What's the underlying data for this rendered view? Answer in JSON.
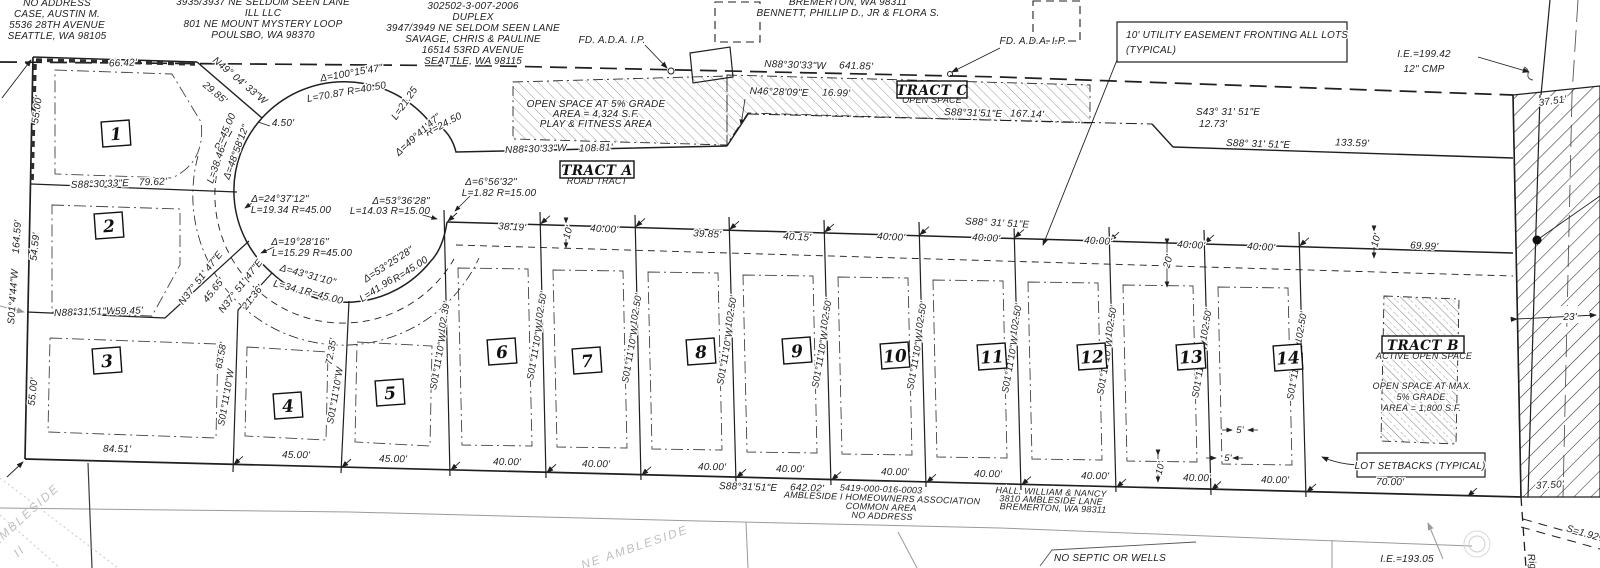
{
  "colors": {
    "ink": "#1f1f1f",
    "gray": "#8c8c8c",
    "ghost": "#c0c0c0",
    "hatch_light": "#6a6a6a",
    "hatch_dark": "#2e2e2e"
  },
  "lots": [
    {
      "n": "1",
      "x": 116,
      "y": 134
    },
    {
      "n": "2",
      "x": 109,
      "y": 226
    },
    {
      "n": "3",
      "x": 107,
      "y": 361
    },
    {
      "n": "4",
      "x": 288,
      "y": 406
    },
    {
      "n": "5",
      "x": 390,
      "y": 393
    },
    {
      "n": "6",
      "x": 502,
      "y": 352
    },
    {
      "n": "7",
      "x": 587,
      "y": 361
    },
    {
      "n": "8",
      "x": 701,
      "y": 352
    },
    {
      "n": "9",
      "x": 797,
      "y": 351
    },
    {
      "n": "10",
      "x": 895,
      "y": 356
    },
    {
      "n": "11",
      "x": 992,
      "y": 357
    },
    {
      "n": "12",
      "x": 1092,
      "y": 357
    },
    {
      "n": "13",
      "x": 1191,
      "y": 357
    },
    {
      "n": "14",
      "x": 1288,
      "y": 358
    }
  ],
  "tracts": [
    {
      "name": "TRACT A",
      "x": 597,
      "y": 170,
      "w": 74
    },
    {
      "name": "TRACT B",
      "x": 1423,
      "y": 345,
      "w": 82
    },
    {
      "name": "TRACT C",
      "x": 932,
      "y": 90,
      "w": 70
    }
  ],
  "labels": [
    {
      "t": "NO ADDRESS",
      "x": 57,
      "y": 6
    },
    {
      "t": "CASE, AUSTIN M.",
      "x": 57,
      "y": 17
    },
    {
      "t": "5536 28TH AVENUE",
      "x": 57,
      "y": 28
    },
    {
      "t": "SEATTLE, WA  98105",
      "x": 57,
      "y": 39
    },
    {
      "t": "3935/3937 NE SELDOM SEEN LANE",
      "x": 263,
      "y": 5
    },
    {
      "t": "ILL LLC",
      "x": 263,
      "y": 16
    },
    {
      "t": "801 NE MOUNT MYSTERY LOOP",
      "x": 263,
      "y": 27
    },
    {
      "t": "POULSBO, WA  98370",
      "x": 263,
      "y": 38
    },
    {
      "t": "302502-3-007-2006",
      "x": 473,
      "y": 9
    },
    {
      "t": "DUPLEX",
      "x": 473,
      "y": 20
    },
    {
      "t": "3947/3949 NE SELDOM SEEN LANE",
      "x": 473,
      "y": 31
    },
    {
      "t": "SAVAGE, CHRIS & PAULINE",
      "x": 473,
      "y": 42
    },
    {
      "t": "16514 53RD AVENUE",
      "x": 473,
      "y": 53
    },
    {
      "t": "SEATTLE, WA  98115",
      "x": 473,
      "y": 64
    },
    {
      "t": "BREMERTON, WA  98311",
      "x": 848,
      "y": 5
    },
    {
      "t": "BENNETT, PHILLIP D., JR & FLORA S.",
      "x": 848,
      "y": 16
    },
    {
      "t": "FD. A.D.A. I.P.",
      "x": 612,
      "y": 43
    },
    {
      "t": "FD. A.D.A. I.P.",
      "x": 1033,
      "y": 44
    },
    {
      "t": "10' UTILITY EASEMENT FRONTING ALL LOTS",
      "x": 1126,
      "y": 38,
      "a": "start"
    },
    {
      "t": "(TYPICAL)",
      "x": 1126,
      "y": 53,
      "a": "start"
    },
    {
      "t": "I.E.=199.42",
      "x": 1424,
      "y": 57
    },
    {
      "t": "12\" CMP",
      "x": 1424,
      "y": 72
    },
    {
      "t": "37.51'",
      "x": 1553,
      "y": 104,
      "r": -8
    },
    {
      "t": "66.42'",
      "x": 123,
      "y": 66,
      "r": -2
    },
    {
      "t": "N49° 04' 33\"W",
      "x": 238,
      "y": 83,
      "r": 40
    },
    {
      "t": "29.85'",
      "x": 213,
      "y": 95,
      "r": 40
    },
    {
      "t": "Δ=100°15'47\"",
      "x": 352,
      "y": 76,
      "r": -10
    },
    {
      "t": "L=70.87   R=40.50",
      "x": 347,
      "y": 95,
      "r": -10
    },
    {
      "t": "4.50'",
      "x": 283,
      "y": 126
    },
    {
      "t": "R=45.00",
      "x": 228,
      "y": 133,
      "r": -67
    },
    {
      "t": "Δ=48°58'12\"",
      "x": 239,
      "y": 153,
      "r": -70
    },
    {
      "t": "L=38.46",
      "x": 219,
      "y": 166,
      "r": -71
    },
    {
      "t": "L=21.25",
      "x": 407,
      "y": 105,
      "r": -55
    },
    {
      "t": "R=24.50",
      "x": 445,
      "y": 127,
      "r": -28
    },
    {
      "t": "Δ=49°41'47\"",
      "x": 420,
      "y": 137,
      "r": -42
    },
    {
      "t": "Δ=24°37'12\"",
      "x": 280,
      "y": 202
    },
    {
      "t": "L=19.34   R=45.00",
      "x": 291,
      "y": 213
    },
    {
      "t": "Δ=19°28'16\"",
      "x": 300,
      "y": 245
    },
    {
      "t": "L=15.29   R=45.00",
      "x": 312,
      "y": 256
    },
    {
      "t": "Δ=43°31'10\"",
      "x": 307,
      "y": 278,
      "r": 15
    },
    {
      "t": "L=34.18",
      "x": 291,
      "y": 291,
      "r": 15
    },
    {
      "t": "R=45.00",
      "x": 323,
      "y": 299,
      "r": 15
    },
    {
      "t": "Δ=53°25'28\"",
      "x": 390,
      "y": 267,
      "r": -33
    },
    {
      "t": "L=41.96",
      "x": 378,
      "y": 292,
      "r": -33
    },
    {
      "t": "R=45.00",
      "x": 412,
      "y": 272,
      "r": -33
    },
    {
      "t": "Δ=53°36'28\"",
      "x": 401,
      "y": 204
    },
    {
      "t": "L=14.03   R=15.00",
      "x": 390,
      "y": 214
    },
    {
      "t": "Δ=6°56'32\"",
      "x": 491,
      "y": 185
    },
    {
      "t": "L=1.82   R=15.00",
      "x": 499,
      "y": 196
    },
    {
      "t": "N37° 51' 47\"E",
      "x": 203,
      "y": 280,
      "r": -52
    },
    {
      "t": "45.65'",
      "x": 216,
      "y": 292,
      "r": -52
    },
    {
      "t": "N37° 51' 47\"E",
      "x": 243,
      "y": 288,
      "r": -52
    },
    {
      "t": "21.36'",
      "x": 255,
      "y": 299,
      "r": -52
    },
    {
      "t": "S88°30'33\"E",
      "x": 100,
      "y": 187,
      "r": -2
    },
    {
      "t": "79.62'",
      "x": 153,
      "y": 185,
      "r": -2
    },
    {
      "t": "55.00'",
      "x": 40,
      "y": 110,
      "r": -82
    },
    {
      "t": "164.59'",
      "x": 20,
      "y": 237,
      "r": -86
    },
    {
      "t": "S01°4'44\"W",
      "x": 16,
      "y": 297,
      "r": -86
    },
    {
      "t": "54.59'",
      "x": 38,
      "y": 247,
      "r": -84
    },
    {
      "t": "55.00'",
      "x": 36,
      "y": 392,
      "r": -84
    },
    {
      "t": "N88°31'51\"W",
      "x": 85,
      "y": 315,
      "r": -2
    },
    {
      "t": "59.45'",
      "x": 129,
      "y": 314,
      "r": -2
    },
    {
      "t": "63.58'",
      "x": 224,
      "y": 356,
      "r": -80,
      "s": 9.5
    },
    {
      "t": "S01°11'10\"W",
      "x": 229,
      "y": 398,
      "r": -80,
      "s": 9.5
    },
    {
      "t": "72.35'",
      "x": 334,
      "y": 352,
      "r": -80,
      "s": 9.5
    },
    {
      "t": "S01°11'10\"W",
      "x": 338,
      "y": 396,
      "r": -80,
      "s": 9.5
    },
    {
      "t": "102.39'",
      "x": 447,
      "y": 318,
      "r": -80,
      "s": 9.5
    },
    {
      "t": "S01°11'10\"W",
      "x": 441,
      "y": 362,
      "r": -80,
      "s": 9.5
    },
    {
      "t": "102.50'",
      "x": 544,
      "y": 308,
      "r": -80,
      "s": 9.5
    },
    {
      "t": "S01°11'10\"W",
      "x": 538,
      "y": 352,
      "r": -80,
      "s": 9.5
    },
    {
      "t": "102.50'",
      "x": 639,
      "y": 310,
      "r": -80,
      "s": 9.5
    },
    {
      "t": "S01°11'10\"W",
      "x": 633,
      "y": 355,
      "r": -80,
      "s": 9.5
    },
    {
      "t": "102.50'",
      "x": 734,
      "y": 312,
      "r": -80,
      "s": 9.5
    },
    {
      "t": "S01°11'10\"W",
      "x": 728,
      "y": 357,
      "r": -80,
      "s": 9.5
    },
    {
      "t": "102.50'",
      "x": 829,
      "y": 315,
      "r": -80,
      "s": 9.5
    },
    {
      "t": "S01°11'10\"W",
      "x": 823,
      "y": 360,
      "r": -80,
      "s": 9.5
    },
    {
      "t": "102.50'",
      "x": 924,
      "y": 318,
      "r": -80,
      "s": 9.5
    },
    {
      "t": "S01°11'10\"W",
      "x": 918,
      "y": 362,
      "r": -80,
      "s": 9.5
    },
    {
      "t": "102.50'",
      "x": 1019,
      "y": 320,
      "r": -80,
      "s": 9.5
    },
    {
      "t": "S01°11'10\"W",
      "x": 1013,
      "y": 365,
      "r": -80,
      "s": 9.5
    },
    {
      "t": "102.50'",
      "x": 1114,
      "y": 322,
      "r": -80,
      "s": 9.5
    },
    {
      "t": "S01°11'10\"W",
      "x": 1108,
      "y": 367,
      "r": -80,
      "s": 9.5
    },
    {
      "t": "102.50'",
      "x": 1209,
      "y": 325,
      "r": -80,
      "s": 9.5
    },
    {
      "t": "S01°11'10\"W",
      "x": 1203,
      "y": 370,
      "r": -80,
      "s": 9.5
    },
    {
      "t": "102.50'",
      "x": 1304,
      "y": 328,
      "r": -80,
      "s": 9.5
    },
    {
      "t": "S01°11'10\"W",
      "x": 1298,
      "y": 372,
      "r": -80,
      "s": 9.5
    },
    {
      "t": "38.19'",
      "x": 512,
      "y": 230,
      "r": 3
    },
    {
      "t": "10'",
      "x": 571,
      "y": 233,
      "r": -75
    },
    {
      "t": "40.00'",
      "x": 604,
      "y": 232,
      "r": 3
    },
    {
      "t": "39.85'",
      "x": 707,
      "y": 237,
      "r": 3
    },
    {
      "t": "40.15'",
      "x": 797,
      "y": 240,
      "r": 3
    },
    {
      "t": "40.00'",
      "x": 891,
      "y": 240,
      "r": 3
    },
    {
      "t": "40.00'",
      "x": 986,
      "y": 241,
      "r": 3
    },
    {
      "t": "40.00'",
      "x": 1098,
      "y": 244,
      "r": 3
    },
    {
      "t": "40.00'",
      "x": 1191,
      "y": 248,
      "r": 3
    },
    {
      "t": "40.00'",
      "x": 1261,
      "y": 250,
      "r": 3
    },
    {
      "t": "S88° 31' 51\"E",
      "x": 997,
      "y": 226,
      "r": 3
    },
    {
      "t": "20'",
      "x": 1171,
      "y": 262,
      "r": -75
    },
    {
      "t": "10'",
      "x": 1379,
      "y": 241,
      "r": -75
    },
    {
      "t": "69.99'",
      "x": 1424,
      "y": 249,
      "r": 3
    },
    {
      "t": "N88°30'33\"W",
      "x": 536,
      "y": 152,
      "r": -2
    },
    {
      "t": "108.81'",
      "x": 596,
      "y": 151,
      "r": -2
    },
    {
      "t": "ROAD TRACT",
      "x": 597,
      "y": 184,
      "s": 9
    },
    {
      "t": "N88°30'33\"W",
      "x": 795,
      "y": 68,
      "r": 2
    },
    {
      "t": "641.85'",
      "x": 856,
      "y": 69,
      "r": 2
    },
    {
      "t": "N46°28'09\"E",
      "x": 779,
      "y": 95,
      "r": 2
    },
    {
      "t": "16.99'",
      "x": 836,
      "y": 96,
      "r": 2
    },
    {
      "t": "OPEN SPACE",
      "x": 932,
      "y": 103,
      "s": 9
    },
    {
      "t": "S88°31'51\"E",
      "x": 973,
      "y": 116,
      "r": 2
    },
    {
      "t": "167.14'",
      "x": 1027,
      "y": 117,
      "r": 2
    },
    {
      "t": "S43° 31' 51\"E",
      "x": 1228,
      "y": 115
    },
    {
      "t": "12.73'",
      "x": 1213,
      "y": 127
    },
    {
      "t": "S88° 31' 51\"E",
      "x": 1258,
      "y": 147,
      "r": 2
    },
    {
      "t": "133.59'",
      "x": 1352,
      "y": 146,
      "r": 2
    },
    {
      "t": "OPEN SPACE AT 5% GRADE",
      "x": 596,
      "y": 107
    },
    {
      "t": "AREA = 4,324 S.F.",
      "x": 596,
      "y": 117
    },
    {
      "t": "PLAY & FITNESS AREA",
      "x": 596,
      "y": 127
    },
    {
      "t": "ACTIVE OPEN SPACE",
      "x": 1424,
      "y": 359,
      "s": 9
    },
    {
      "t": "OPEN SPACE AT MAX.",
      "x": 1422,
      "y": 389,
      "s": 9
    },
    {
      "t": "5% GRADE",
      "x": 1421,
      "y": 400,
      "s": 9
    },
    {
      "t": "AREA = 1,800 S.F.",
      "x": 1422,
      "y": 411,
      "s": 9
    },
    {
      "t": "23'",
      "x": 1570,
      "y": 320
    },
    {
      "t": "37.50'",
      "x": 1550,
      "y": 488,
      "r": -3
    },
    {
      "t": "S=1.92%",
      "x": 1586,
      "y": 537,
      "r": 16
    },
    {
      "t": "Rig",
      "x": 1529,
      "y": 562,
      "r": 80
    },
    {
      "t": "5'",
      "x": 1240,
      "y": 433,
      "s": 9.5
    },
    {
      "t": "5'",
      "x": 1228,
      "y": 461,
      "s": 9.5
    },
    {
      "t": "10'",
      "x": 1163,
      "y": 469,
      "r": -75,
      "s": 9.5
    },
    {
      "t": "LOT SETBACKS (TYPICAL)",
      "x": 1420,
      "y": 469
    },
    {
      "t": "84.51'",
      "x": 117,
      "y": 452,
      "r": 1
    },
    {
      "t": "45.00'",
      "x": 296,
      "y": 458,
      "r": 1
    },
    {
      "t": "45.00'",
      "x": 393,
      "y": 462,
      "r": 1
    },
    {
      "t": "40.00'",
      "x": 507,
      "y": 465,
      "r": 1
    },
    {
      "t": "40.00'",
      "x": 596,
      "y": 467,
      "r": 1
    },
    {
      "t": "40.00'",
      "x": 712,
      "y": 470,
      "r": 1
    },
    {
      "t": "40.00'",
      "x": 790,
      "y": 472,
      "r": 1
    },
    {
      "t": "40.00'",
      "x": 895,
      "y": 475,
      "r": 1
    },
    {
      "t": "40.00'",
      "x": 988,
      "y": 477,
      "r": 1
    },
    {
      "t": "40.00'",
      "x": 1095,
      "y": 479,
      "r": 1
    },
    {
      "t": "40.00'",
      "x": 1197,
      "y": 481,
      "r": 1
    },
    {
      "t": "40.00'",
      "x": 1275,
      "y": 483,
      "r": 1
    },
    {
      "t": "70.00'",
      "x": 1390,
      "y": 485,
      "r": 1
    },
    {
      "t": "S88°31'51\"E",
      "x": 748,
      "y": 490,
      "r": 2
    },
    {
      "t": "642.02'",
      "x": 807,
      "y": 491,
      "r": 2
    },
    {
      "t": "5419-000-016-0003",
      "x": 881,
      "y": 492,
      "r": 2,
      "s": 9
    },
    {
      "t": "AMBLESIDE I HOMEOWNERS ASSOCIATION",
      "x": 882,
      "y": 501,
      "r": 2,
      "s": 9
    },
    {
      "t": "COMMON AREA",
      "x": 881,
      "y": 510,
      "r": 2,
      "s": 9
    },
    {
      "t": "NO ADDRESS",
      "x": 882,
      "y": 519,
      "r": 2,
      "s": 9
    },
    {
      "t": "HALL, WILLIAM & NANCY",
      "x": 1051,
      "y": 495,
      "r": 2,
      "s": 9
    },
    {
      "t": "3810 AMBLESIDE LANE",
      "x": 1051,
      "y": 503,
      "r": 2,
      "s": 9
    },
    {
      "t": "BREMERTON, WA  98311",
      "x": 1053,
      "y": 511,
      "r": 2,
      "s": 9
    },
    {
      "t": "NO SEPTIC OR WELLS",
      "x": 1110,
      "y": 561
    },
    {
      "t": "I.E.=193.05",
      "x": 1407,
      "y": 562
    },
    {
      "t": "NE AMBLESIDE",
      "x": 636,
      "y": 551,
      "r": -19,
      "c": "g"
    },
    {
      "t": "AMBLESIDE",
      "x": 28,
      "y": 518,
      "r": -42,
      "c": "g"
    },
    {
      "t": "II",
      "x": 22,
      "y": 554,
      "r": -42,
      "c": "g"
    }
  ]
}
